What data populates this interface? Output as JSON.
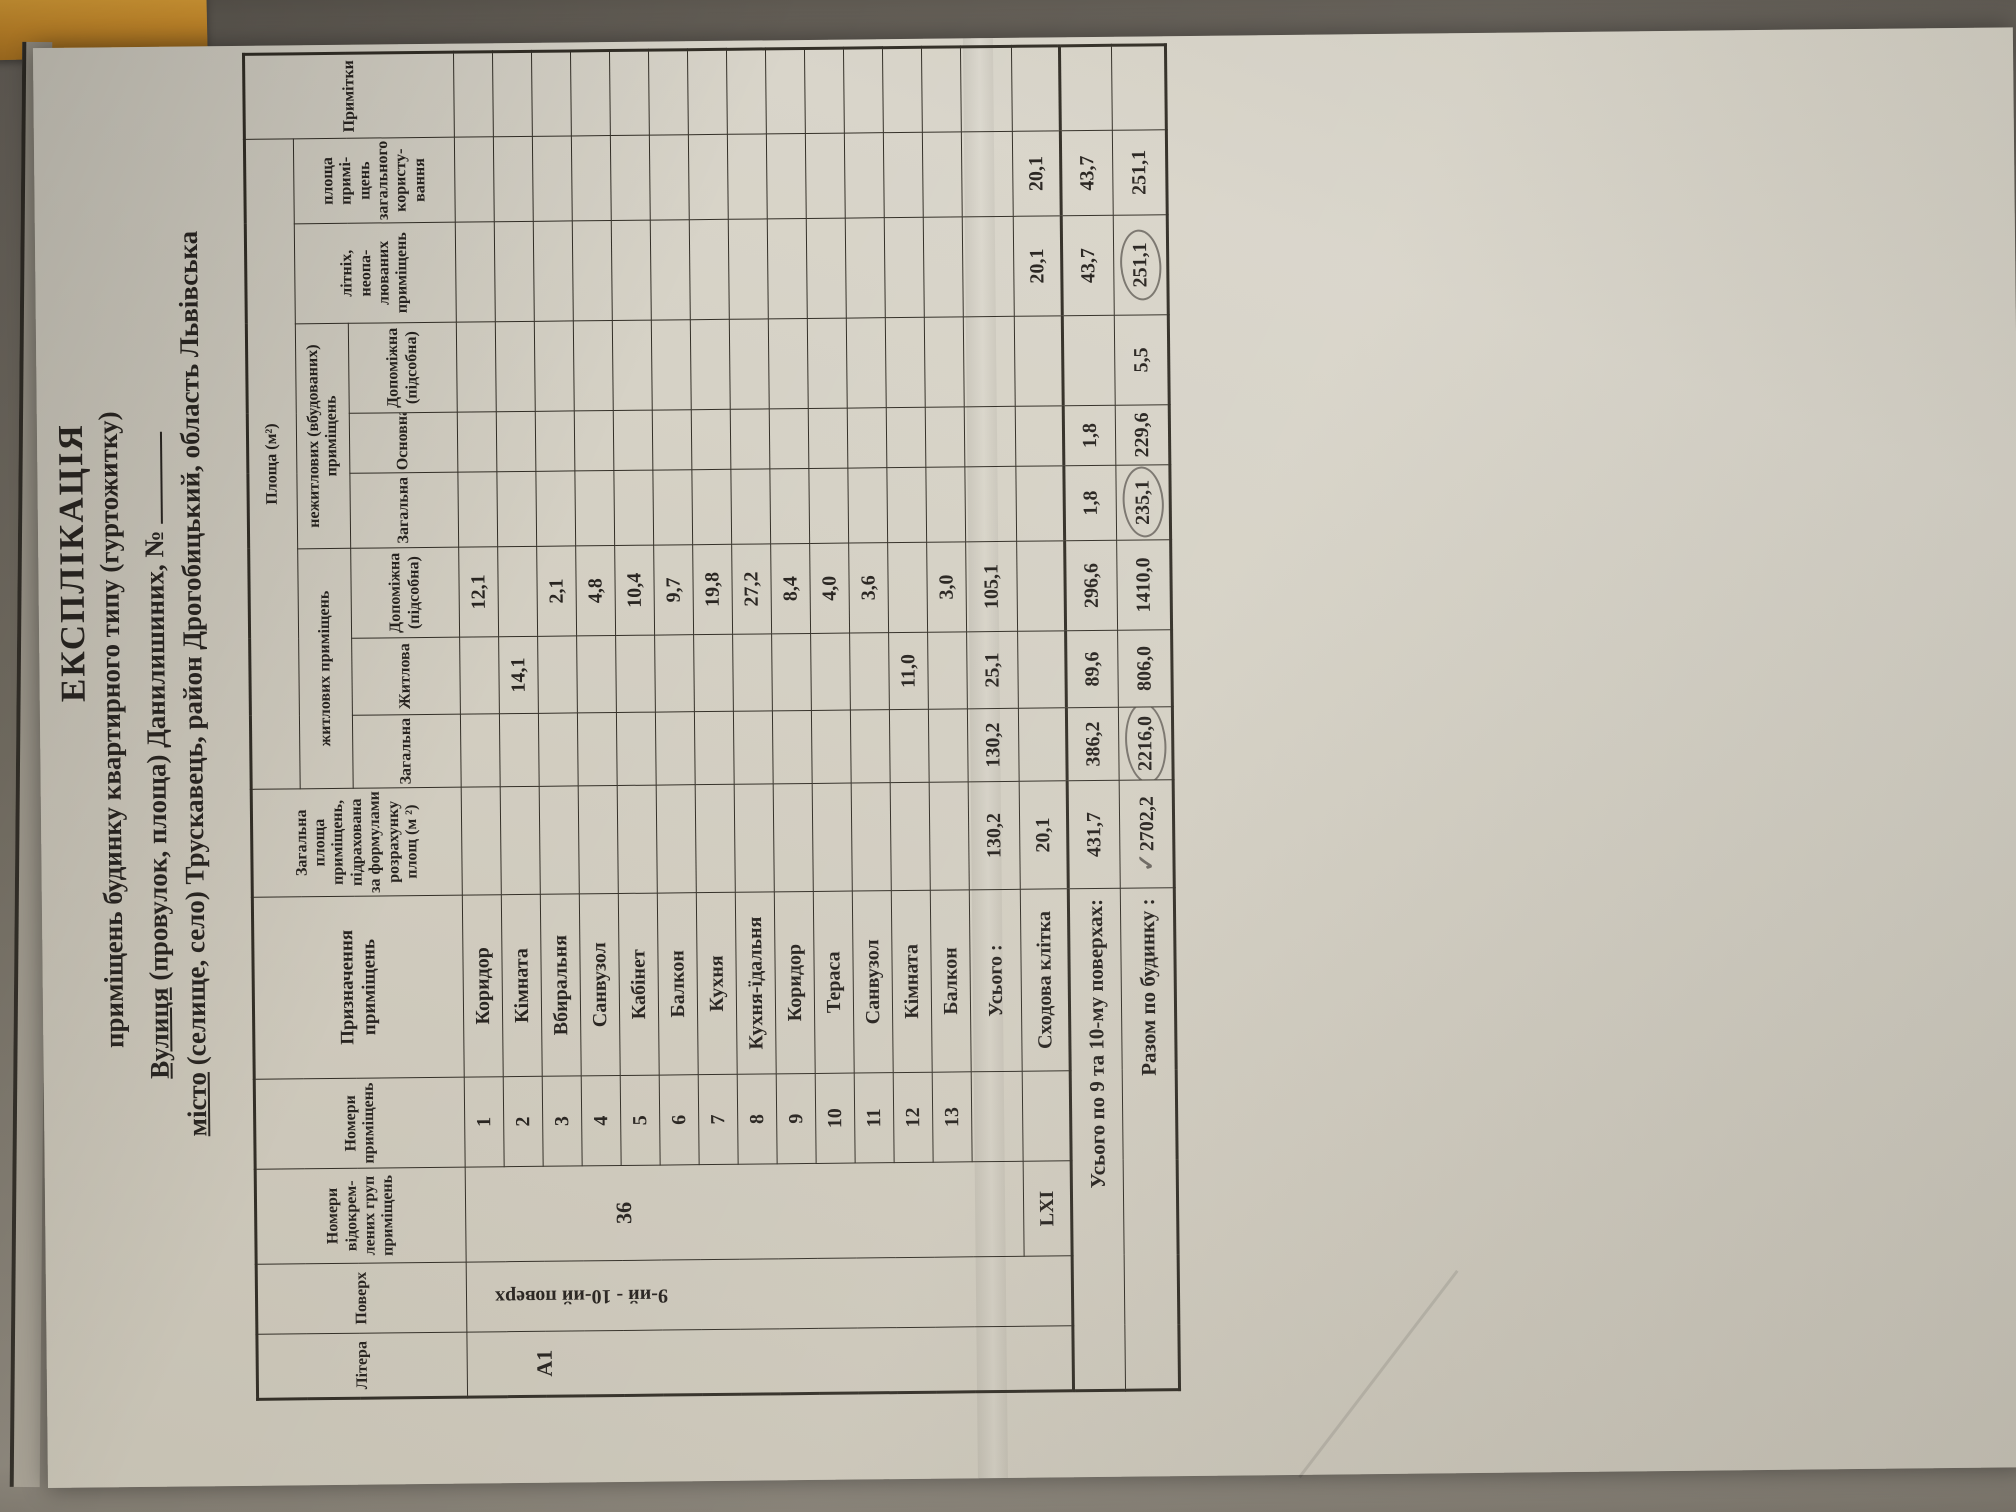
{
  "photo": {
    "background": "#7b7569",
    "paper_color": "#d2cec2",
    "ink_color": "#2b2723",
    "pencil_color": "#68645d",
    "orange_tab_color": "#d3922d"
  },
  "title": {
    "line1": "ЕКСПЛІКАЦІЯ",
    "line2": "приміщень будинку квартирного типу (гуртожитку)",
    "street_label": "Вулиця",
    "street_hint": "(провулок, площа)",
    "street_value": "Данилишиних, №",
    "city_label": "місто",
    "city_hint": "(селище, село)",
    "city_value": "Трускавець,  район Дрогобицький, область Львівська"
  },
  "header": {
    "litera": "Літера",
    "poverh": "Поверх",
    "group_numbers": "Номери відокрем­лених груп примі­щень",
    "room_numbers": "Номери приміщень",
    "purpose": "Призначення приміщень",
    "total_area": "Загальна площа приміщень, підрахована за формулами розрахунку площ (м ²)",
    "area_group": "Площа (м²)",
    "residential_group": "житлових приміщень",
    "nonresidential_group": "нежитлових (вбудованих) приміщень",
    "res_total": "Загальна",
    "res_living": "Житлова",
    "res_aux": "Допоміжна (підсобна)",
    "nonres_total": "Загальна",
    "nonres_main": "Основна",
    "nonres_aux": "Допоміжна (підсобна)",
    "summer": "літніх, неопа­люваних примі­щень",
    "common": "площа примі­щень загаль­ного користу­вання",
    "notes": "Примітки"
  },
  "body": {
    "litera": "А1",
    "poverh": "9-ий - 10-ий поверх",
    "group_no": "36",
    "stair_group_no": "LXI",
    "rows": [
      {
        "n": "1",
        "name": "Коридор",
        "zh": "",
        "dop": "12,1"
      },
      {
        "n": "2",
        "name": "Кімната",
        "zh": "14,1",
        "dop": ""
      },
      {
        "n": "3",
        "name": "Вбиральня",
        "zh": "",
        "dop": "2,1"
      },
      {
        "n": "4",
        "name": "Санвузол",
        "zh": "",
        "dop": "4,8"
      },
      {
        "n": "5",
        "name": "Кабінет",
        "zh": "",
        "dop": "10,4"
      },
      {
        "n": "6",
        "name": "Балкон",
        "zh": "",
        "dop": "9,7"
      },
      {
        "n": "7",
        "name": "Кухня",
        "zh": "",
        "dop": "19,8"
      },
      {
        "n": "8",
        "name": "Кухня-їдальня",
        "zh": "",
        "dop": "27,2"
      },
      {
        "n": "9",
        "name": "Коридор",
        "zh": "",
        "dop": "8,4"
      },
      {
        "n": "10",
        "name": "Тераса",
        "zh": "",
        "dop": "4,0"
      },
      {
        "n": "11",
        "name": "Санвузол",
        "zh": "",
        "dop": "3,6"
      },
      {
        "n": "12",
        "name": "Кімната",
        "zh": "11,0",
        "dop": ""
      },
      {
        "n": "13",
        "name": "Балкон",
        "zh": "",
        "dop": "3,0"
      }
    ],
    "usogo": {
      "label": "Усього :",
      "total": "130,2",
      "res_total": "130,2",
      "living": "25,1",
      "aux": "105,1"
    },
    "stair": {
      "label": "Сходова клітка",
      "total": "20,1",
      "summer": "20,1",
      "common": "20,1"
    },
    "floors": {
      "label": "Усього по 9 та 10-му поверхах:",
      "total": "431,7",
      "res_total": "386,2",
      "living": "89,6",
      "aux": "296,6",
      "nonres_total": "1,8",
      "main": "1,8",
      "summer": "43,7",
      "common": "43,7"
    },
    "building": {
      "label": "Разом  по будинку :",
      "total": "2702,2",
      "res_total": "2216,0",
      "living": "806,0",
      "aux": "1410,0",
      "nonres_total": "235,1",
      "main": "229,6",
      "nonres_aux": "5,5",
      "summer": "251,1",
      "common": "251,1"
    }
  },
  "annotations": {
    "pencil_checkmark": "✓"
  }
}
